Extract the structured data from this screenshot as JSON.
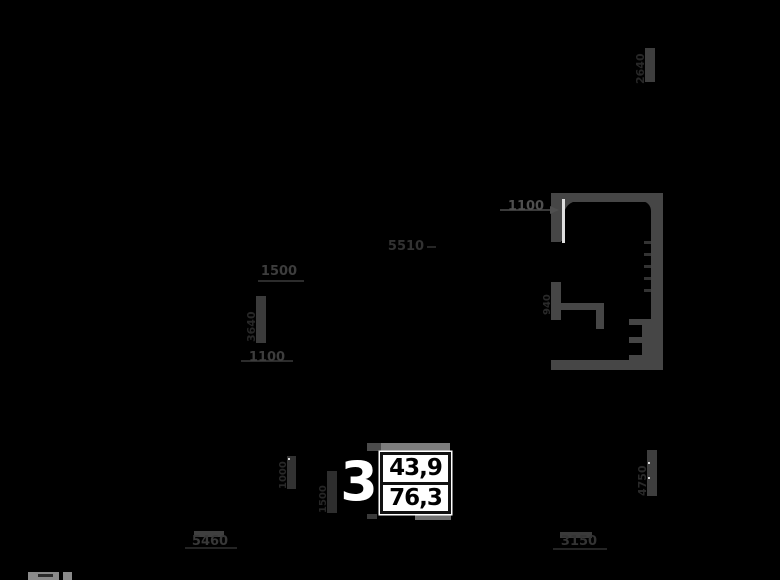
{
  "apartment": {
    "number": "3",
    "area_living": "43,9",
    "area_total": "76,3"
  },
  "dimensions": {
    "door_width_top": "1100",
    "width_1500": "1500",
    "width_5510": "5510",
    "width_left_1100": "1100",
    "vert_left": "3640",
    "vert_top_right": "2640",
    "vert_room_left": "940",
    "vert_right": "4750",
    "vert_inner_a": "1000",
    "vert_inner_b": "1500",
    "bottom_left_width": "5460",
    "bottom_right_width": "3150"
  },
  "colors": {
    "background": "#000000",
    "wall_gray": "#464646",
    "bright_wall": "#7d7d7d",
    "dim_text": "#2e2e2e",
    "info_box_bg": "#ffffff",
    "info_text": "#000000",
    "door_leaf": "#e0e0e0"
  }
}
